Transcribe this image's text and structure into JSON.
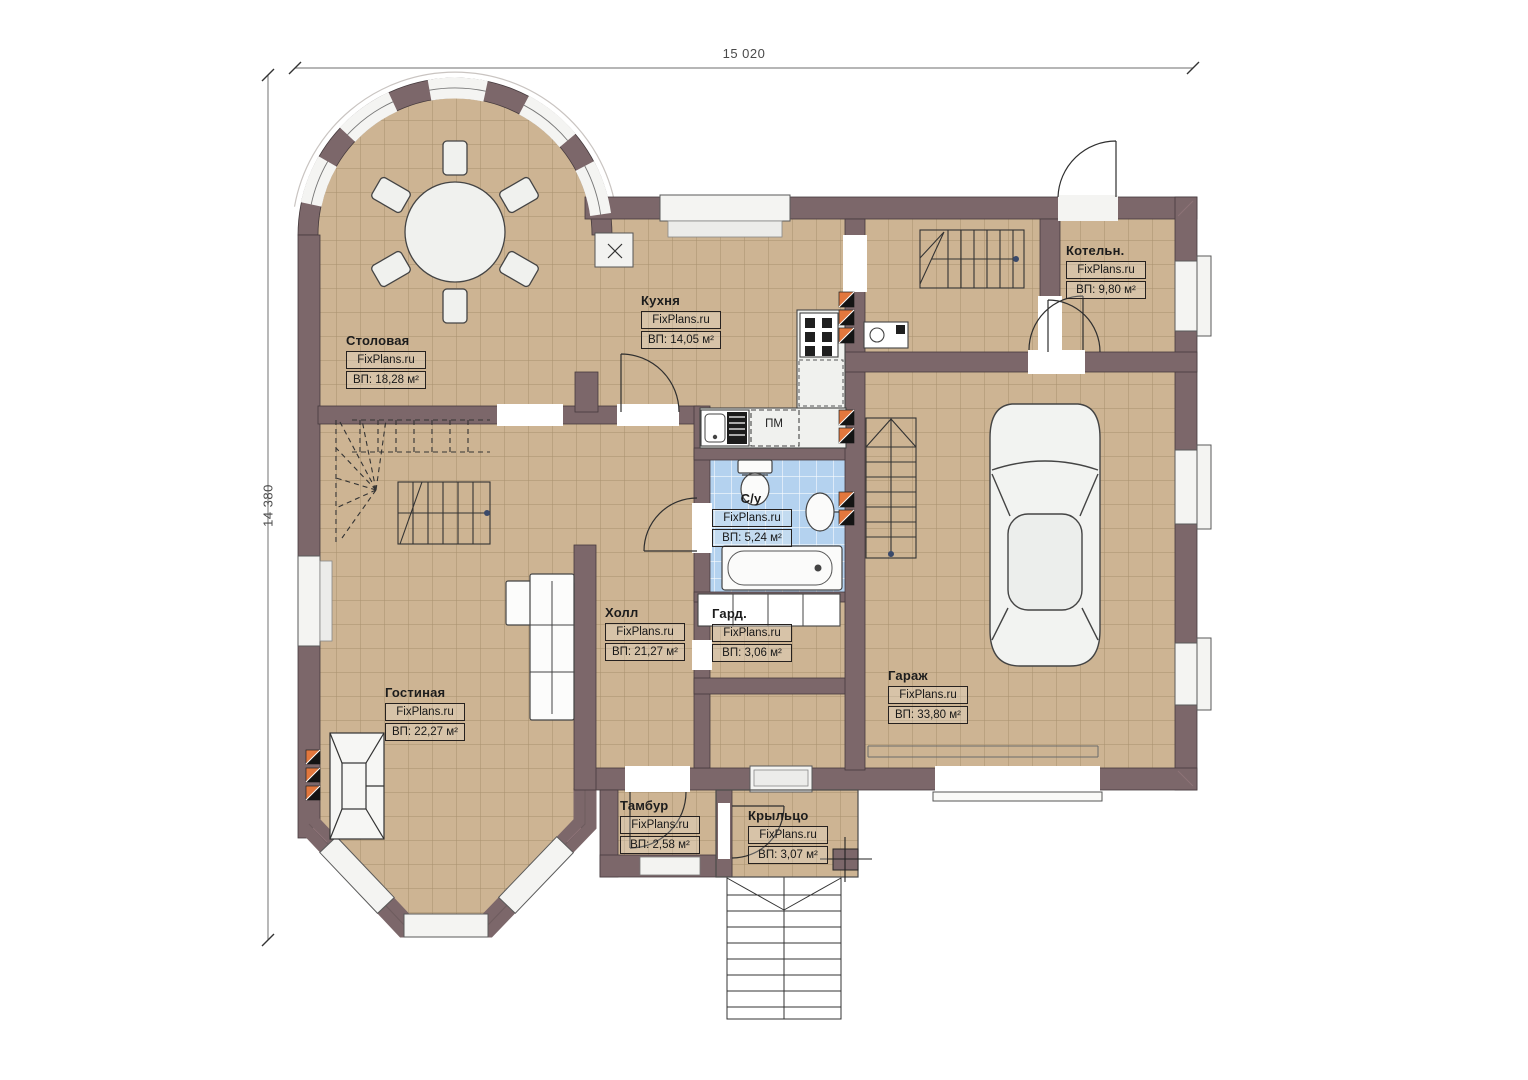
{
  "plan": {
    "watermark": "FixPlans.ru",
    "dimensions": {
      "width": "15 020",
      "height": "14 380"
    },
    "rooms": [
      {
        "name": "Столовая",
        "area": "ВП: 18,28 м²"
      },
      {
        "name": "Кухня",
        "area": "ВП: 14,05 м²"
      },
      {
        "name": "Котельн.",
        "area": "ВП: 9,80 м²"
      },
      {
        "name": "С/у",
        "area": "ВП: 5,24 м²"
      },
      {
        "name": "Холл",
        "area": "ВП: 21,27 м²"
      },
      {
        "name": "Гард.",
        "area": "ВП: 3,06 м²"
      },
      {
        "name": "Гостиная",
        "area": "ВП: 22,27 м²"
      },
      {
        "name": "Гараж",
        "area": "ВП: 33,80 м²"
      },
      {
        "name": "Тамбур",
        "area": "ВП: 2,58 м²"
      },
      {
        "name": "Крыльцо",
        "area": "ВП: 3,07 м²"
      }
    ],
    "annotations": {
      "dishwasher": "ПМ"
    },
    "colors": {
      "wall": "#7C676A",
      "floor_tan": "#CDB493",
      "floor_grid": "#A8906E",
      "floor_blue": "#B4D2EF",
      "vent_orange": "#E2773D",
      "fixture": "#F0F1EE"
    }
  }
}
